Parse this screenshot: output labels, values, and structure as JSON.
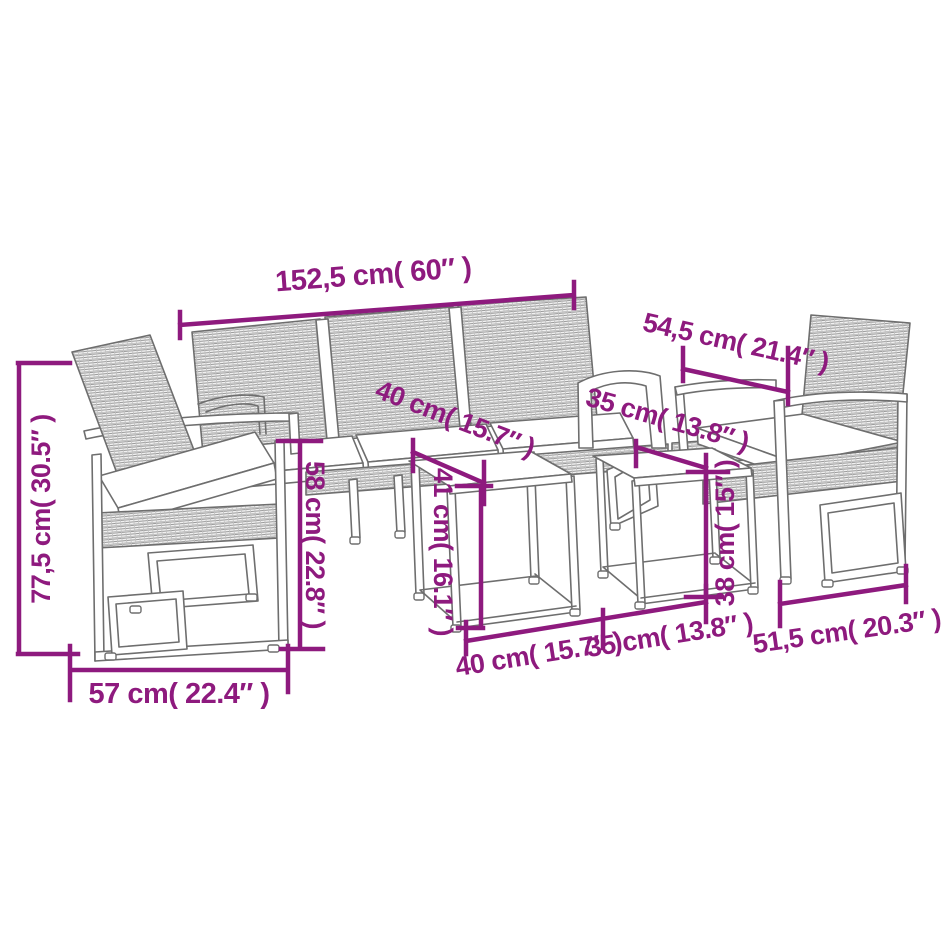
{
  "diagram": {
    "background_color": "#ffffff",
    "dimension_color": "#8E1A7E",
    "furniture_outline_color": "#6e6e6e",
    "dimensions": {
      "sofa_width": "152,5 cm( 60″ )",
      "armchair_depth": "54,5 cm( 21.4″ )",
      "overall_height": "77,5 cm( 30.5″ )",
      "seat_back_height": "58 cm( 22.8″ )",
      "large_table_top_depth": "40 cm( 15.7″ )",
      "small_table_top_depth": "35 cm( 13.8″ )",
      "large_table_height": "41 cm( 16.1″ )",
      "small_table_height": "38 cm( 15″ )",
      "armchair_width": "57 cm( 22.4″ )",
      "large_table_width": "40 cm( 15.7″ )",
      "small_table_width": "35 cm( 13.8″ )",
      "armchair_seat_width": "51,5 cm( 20.3″ )"
    }
  }
}
